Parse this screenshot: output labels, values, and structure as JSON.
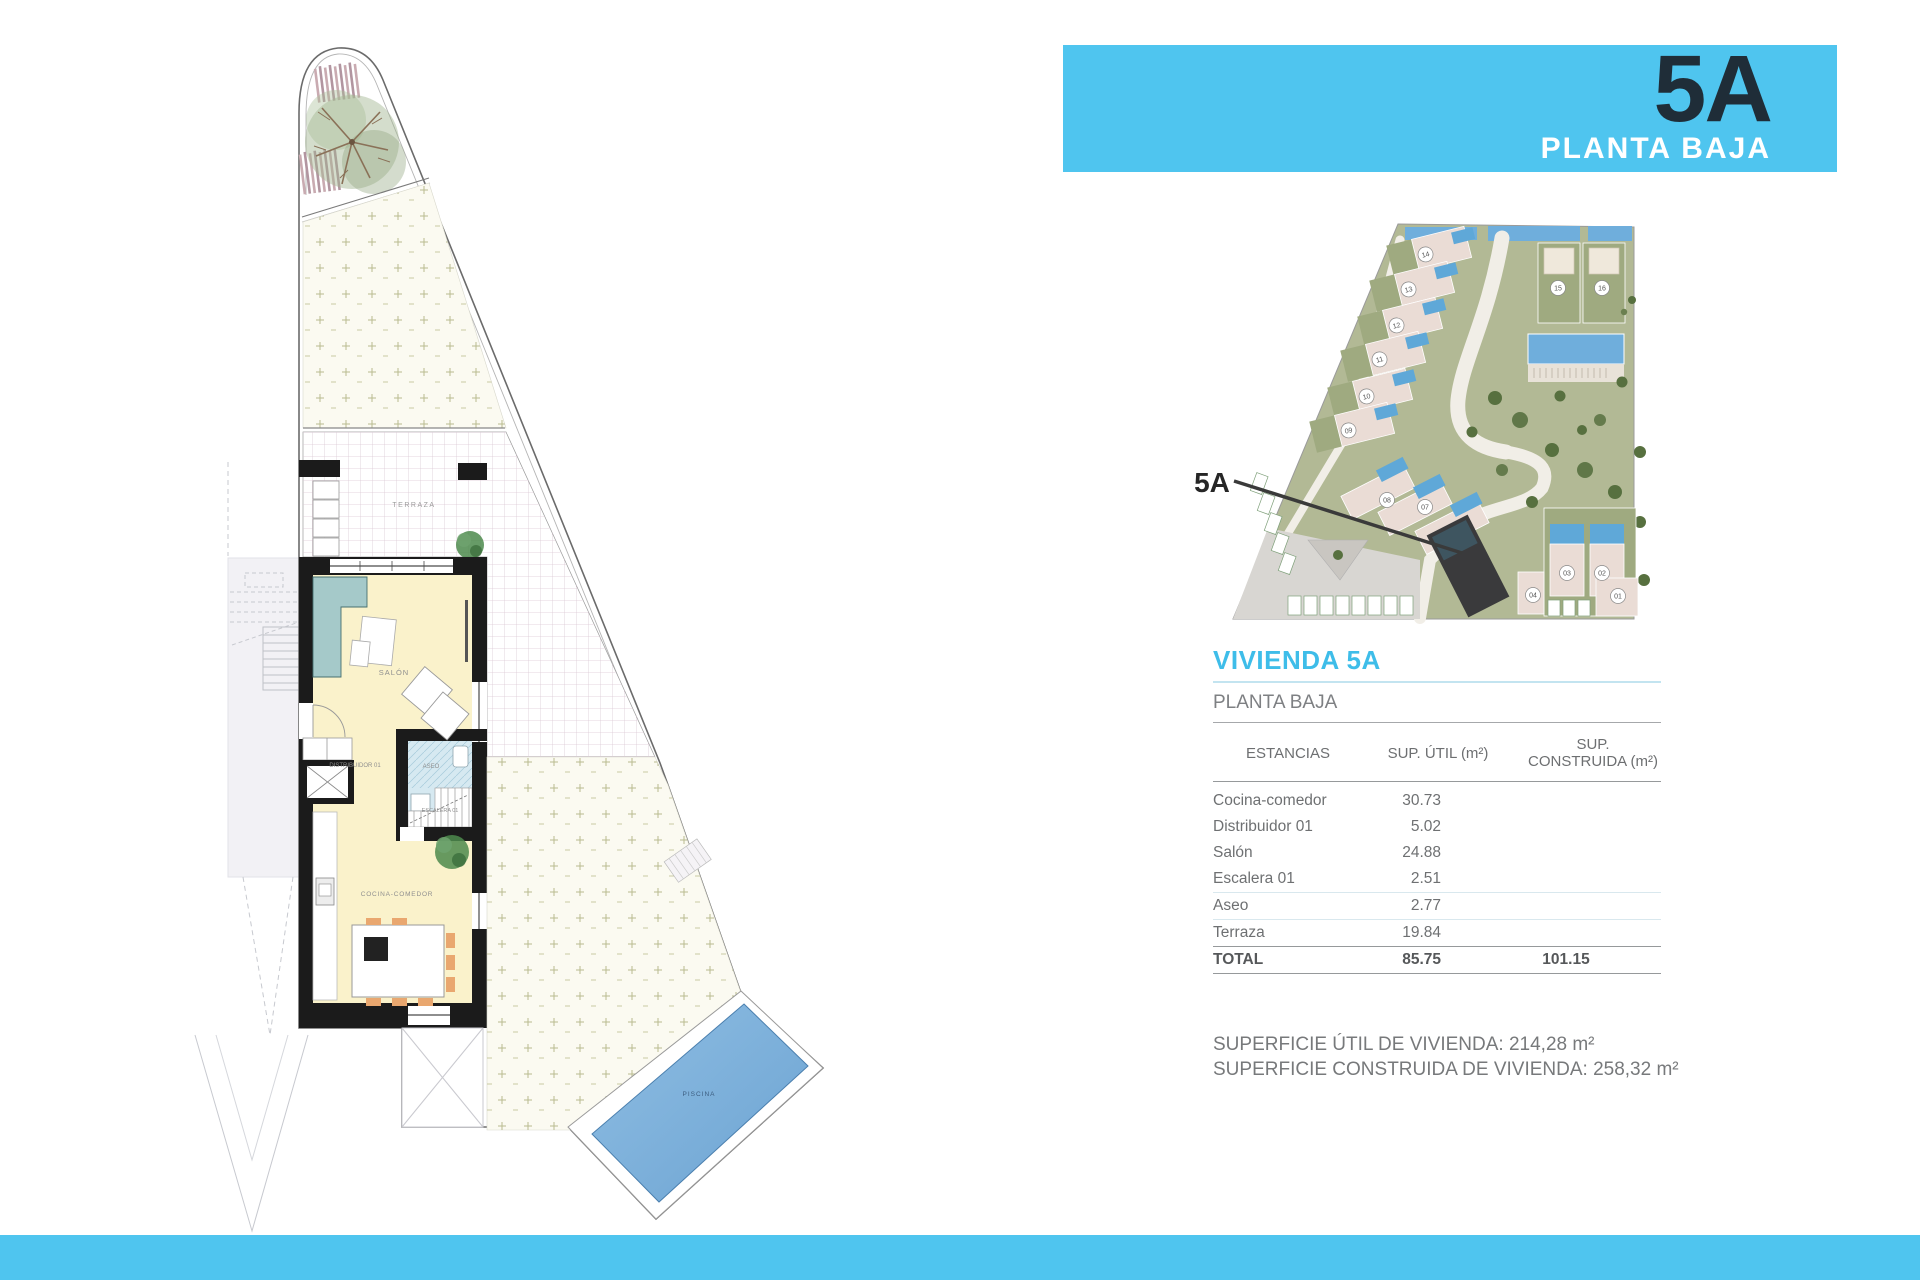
{
  "banner": {
    "unit": "5A",
    "floor": "PLANTA BAJA"
  },
  "site_map": {
    "callout": "5A",
    "unit_labels": [
      "14",
      "13",
      "12",
      "11",
      "10",
      "09",
      "15",
      "16",
      "08",
      "07",
      "05",
      "03",
      "02",
      "04",
      "01"
    ]
  },
  "plan_labels": {
    "terraza": "TERRAZA",
    "salon": "SALÓN",
    "distribuidor": "DISTRIBUIDOR 01",
    "aseo": "ASEO",
    "escalera": "ESCALERA 01",
    "cocina": "COCINA-COMEDOR",
    "piscina": "PISCINA"
  },
  "info": {
    "title": "VIVIENDA 5A",
    "subtitle": "PLANTA BAJA",
    "columns": {
      "room": "ESTANCIAS",
      "util": "SUP. ÚTIL (m²)",
      "built": "SUP. CONSTRUIDA (m²)"
    },
    "rows": [
      {
        "room": "Cocina-comedor",
        "util": "30.73",
        "built": ""
      },
      {
        "room": "Distribuidor 01",
        "util": "5.02",
        "built": ""
      },
      {
        "room": "Salón",
        "util": "24.88",
        "built": ""
      },
      {
        "room": "Escalera 01",
        "util": "2.51",
        "built": ""
      },
      {
        "room": "Aseo",
        "util": "2.77",
        "built": ""
      },
      {
        "room": "Terraza",
        "util": "19.84",
        "built": ""
      }
    ],
    "total": {
      "room": "TOTAL",
      "util": "85.75",
      "built": "101.15"
    },
    "summary_line1": "SUPERFICIE ÚTIL DE VIVIENDA: 214,28 m²",
    "summary_line2": "SUPERFICIE CONSTRUIDA DE VIVIENDA: 258,32 m²"
  },
  "colors": {
    "accent": "#4FC5EF",
    "title_cyan": "#3EBDE9",
    "banner_text_dark": "#1F2D38"
  }
}
